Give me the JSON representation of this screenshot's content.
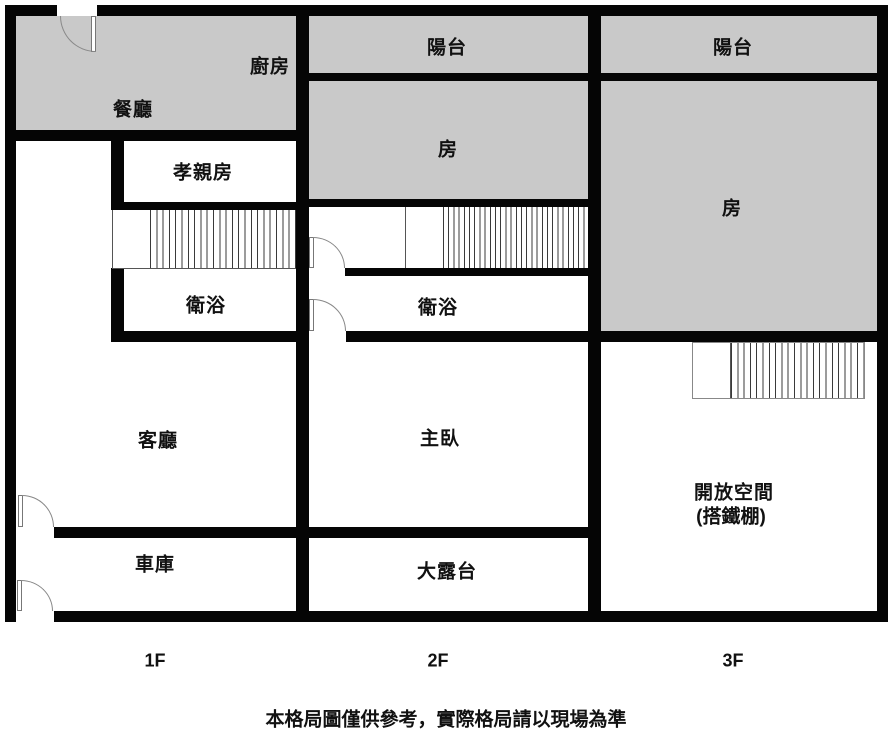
{
  "floor_plan": {
    "rooms": {
      "kitchen": {
        "label": "廚房"
      },
      "dining": {
        "label": "餐廳"
      },
      "elder_room": {
        "label": "孝親房"
      },
      "bath_1f": {
        "label": "衛浴"
      },
      "living_room": {
        "label": "客廳"
      },
      "garage": {
        "label": "車庫"
      },
      "balcony_2f": {
        "label": "陽台"
      },
      "room_2f": {
        "label": "房"
      },
      "bath_2f": {
        "label": "衛浴"
      },
      "master_bedroom": {
        "label": "主臥"
      },
      "terrace": {
        "label": "大露台"
      },
      "balcony_3f": {
        "label": "陽台"
      },
      "room_3f": {
        "label": "房"
      },
      "open_space": {
        "label": "開放空間",
        "sublabel": "(搭鐵棚)"
      }
    },
    "floors": [
      {
        "label": "1F"
      },
      {
        "label": "2F"
      },
      {
        "label": "3F"
      }
    ],
    "disclaimer": "本格局圖僅供參考，實際格局請以現場為準",
    "colors": {
      "wall": "#050505",
      "room_fill": "#c9c9c9",
      "background": "#ffffff",
      "door_line": "#888888"
    }
  }
}
